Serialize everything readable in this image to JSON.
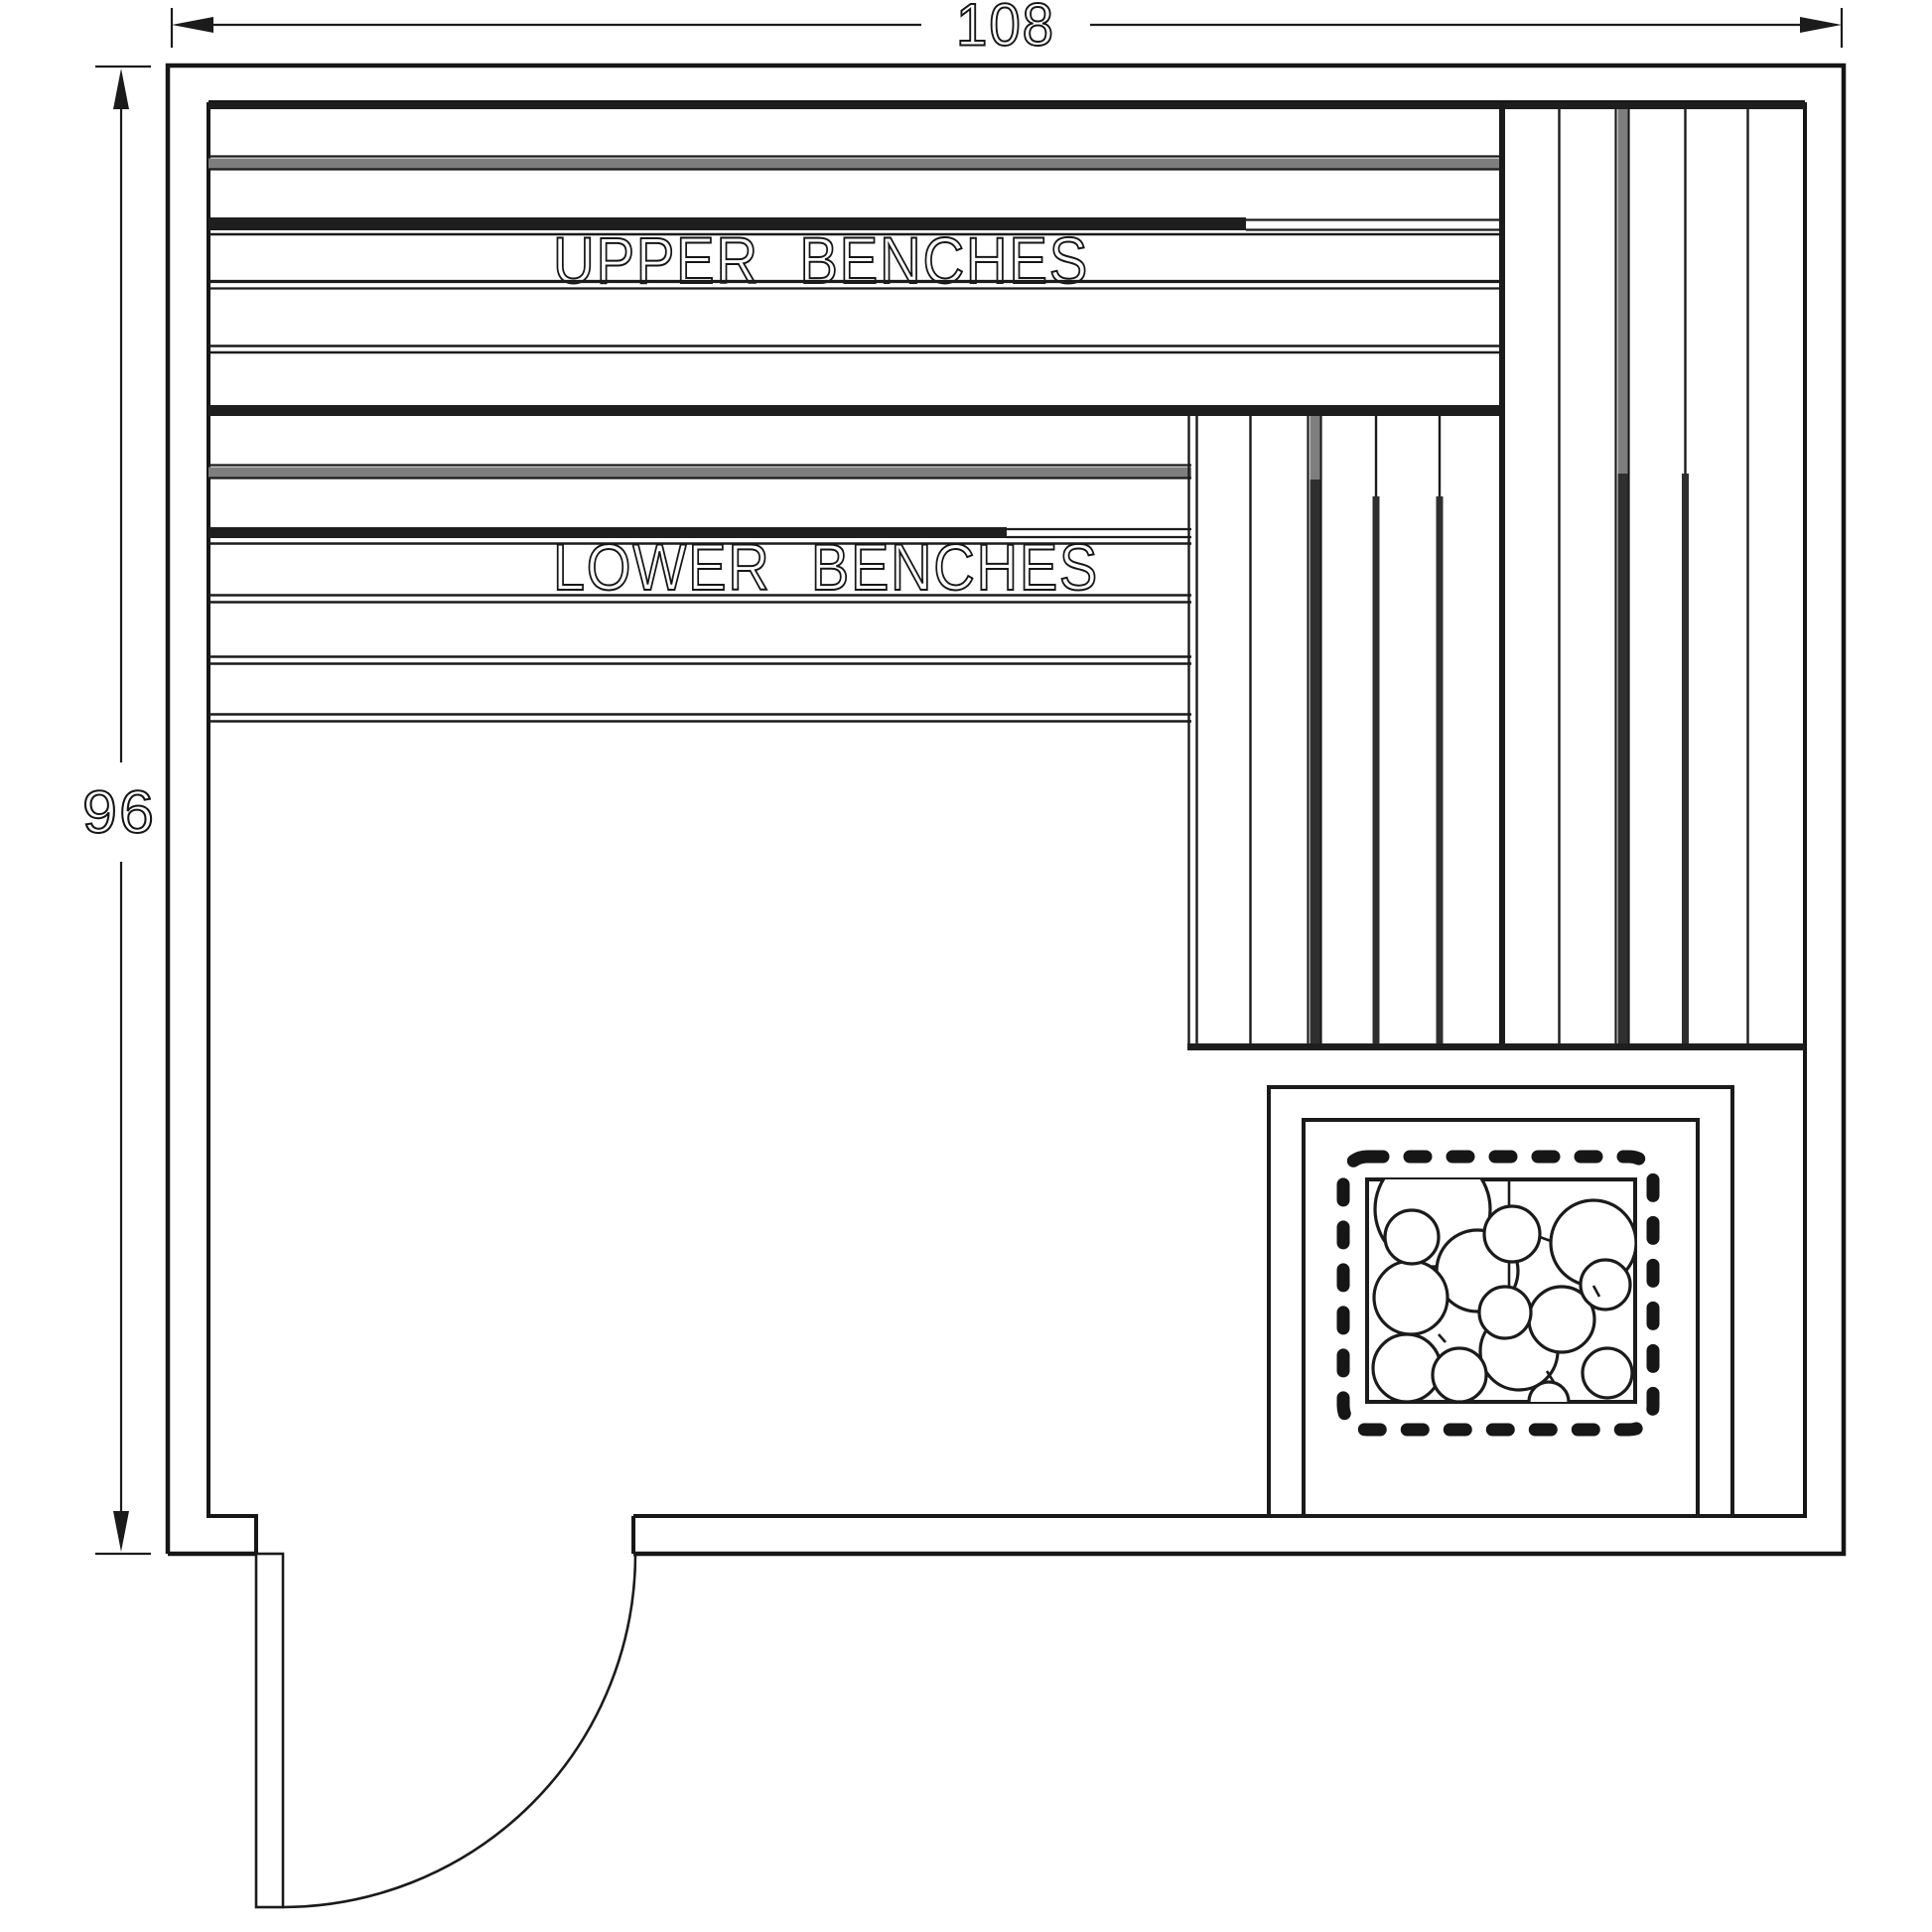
{
  "drawing": {
    "title": "Sauna bench layout floor plan",
    "dimensions": {
      "width_inches": "108",
      "height_inches": "96"
    },
    "labels": {
      "upper_benches": "UPPER BENCHES",
      "lower_benches": "LOWER BENCHES"
    },
    "colors": {
      "line": "#161616",
      "gray_plank": "#7e7e7e",
      "background": "#ffffff"
    }
  }
}
